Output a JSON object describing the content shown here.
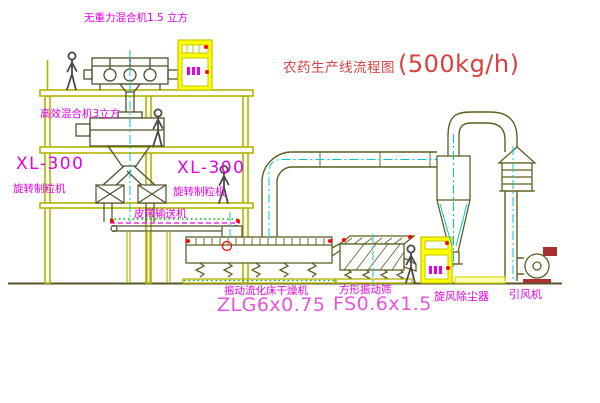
{
  "diagram": {
    "title": {
      "name_part": "农药生产线流程图",
      "capacity_part": "(500kg/h)"
    },
    "labels": {
      "zero_gravity_mixer": "无重力混合机1.5 立方",
      "high_eff_mixer": "高效混合机3立方",
      "xl300_left": "XL-300",
      "rotary_granulator_left": "旋转制粒机",
      "xl300_mid": "XL-300",
      "rotary_granulator_mid": "旋转制粒机",
      "belt_conveyor": "皮带输送机",
      "dryer_name": "振动流化床干燥机",
      "dryer_model": "ZLG6x0.75",
      "sieve_name": "方形振动筛",
      "sieve_model": "FS0.6x1.5",
      "cyclone": "旋风除尘器",
      "induced_fan": "引风机"
    },
    "colors": {
      "structure_olive": "#b2b200",
      "machine_olive": "#5f5f22",
      "label_magenta": "#e400e4",
      "model_magenta": "#e654de",
      "title_red": "#d84040",
      "centerline_cyan": "#00c8c8",
      "cabinet_yellow": "#ffff00",
      "accent_red": "#ff0000",
      "accent_green": "#00b000",
      "people_gray": "#4a4a4a"
    }
  }
}
